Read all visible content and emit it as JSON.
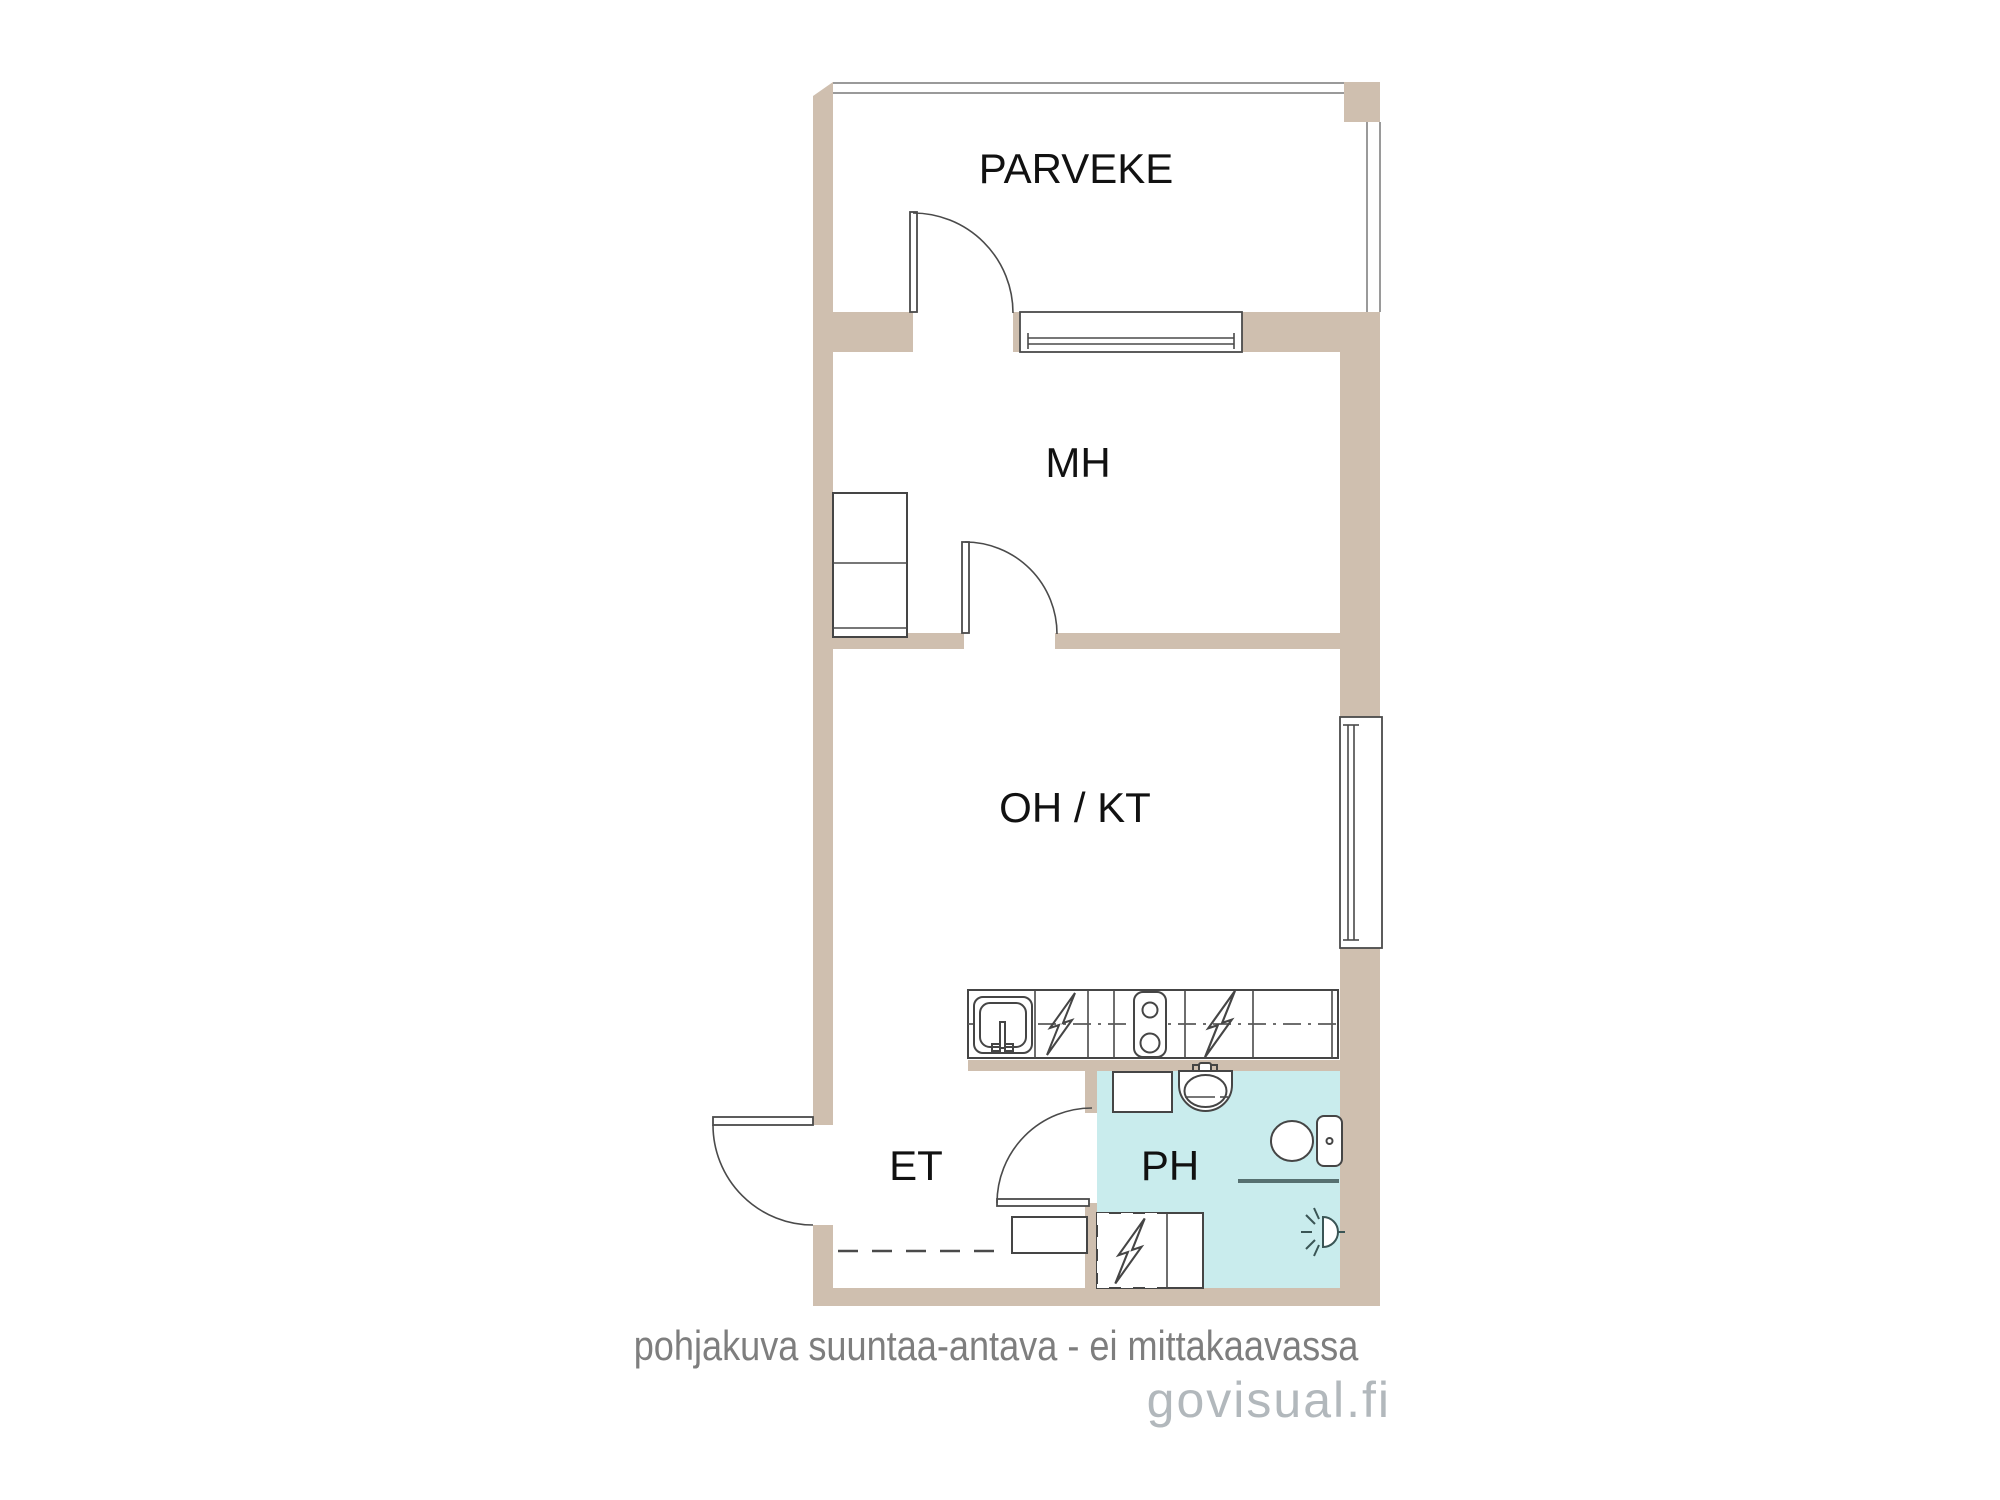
{
  "colors": {
    "wall": "#cfbfaf",
    "bath_floor": "#c9eced",
    "line": "#4a4a4a",
    "thin_line": "#9a9a9a",
    "fixture_line": "#454545",
    "shower_line": "#567070",
    "label": "#111111",
    "note": "#7e7e7e",
    "brand": "#b2b8bc",
    "paper": "#ffffff"
  },
  "rooms": {
    "balcony": "PARVEKE",
    "bedroom": "MH",
    "living_kitchen": "OH / KT",
    "hall": "ET",
    "bathroom": "PH"
  },
  "footer": {
    "disclaimer": "pohjakuva suuntaa-antava - ei mittakaavassa",
    "watermark": "govisual.fi"
  },
  "icons": {
    "appliance": "lightning-bolt-icon",
    "kitchen_sink": "kitchen-sink-icon",
    "stove": "stove-burners-icon",
    "washbasin": "washbasin-icon",
    "toilet": "toilet-icon",
    "light_point": "light-point-icon",
    "shower_screen": "shower-screen-line"
  }
}
